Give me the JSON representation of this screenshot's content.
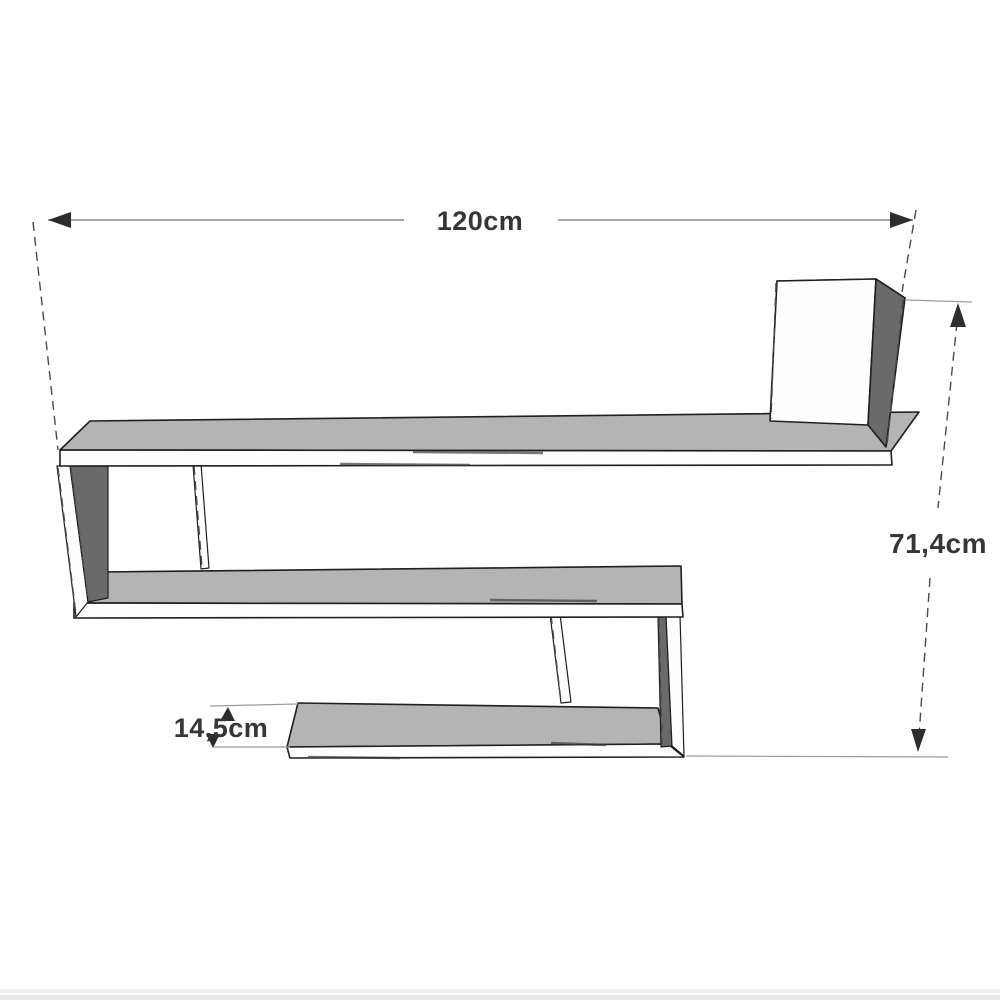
{
  "diagram": {
    "type": "furniture-dimension-drawing",
    "dimensions": {
      "width_label": "120cm",
      "height_label": "71,4cm",
      "depth_label": "14,5cm"
    },
    "colors": {
      "shelf_top_face": "#b4b4b4",
      "shelf_front_face": "#fdfdfd",
      "shelf_side_dark": "#6a6a6a",
      "outline": "#1f1f1f",
      "dimension_line": "#8a8a8a",
      "extension_line": "#9a9a9a",
      "dashed_line": "#4a4a4a",
      "arrow": "#2d2d2d",
      "label_text": "#363636",
      "label_font_size_px": "27",
      "footer_bar_light": "#f1f1f1",
      "footer_bar_dark": "#e8e8e8"
    }
  }
}
